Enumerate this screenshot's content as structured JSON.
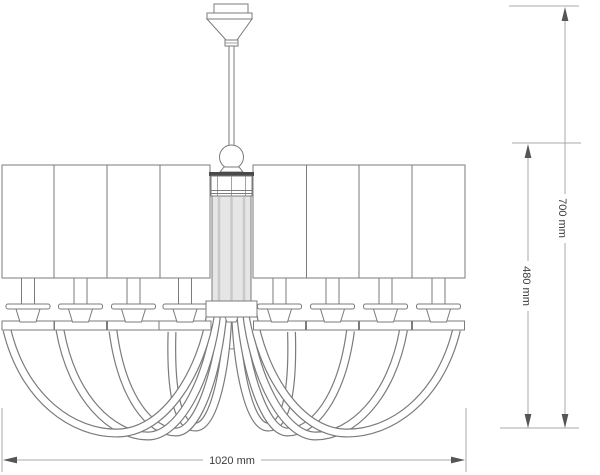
{
  "drawing": {
    "subject": "chandelier-front-elevation",
    "shade_panels_left": 4,
    "shade_panels_right": 4,
    "arm_count": 8,
    "dimensions": {
      "width_label": "1020 mm",
      "overall_height_label": "700 mm",
      "body_height_label": "480 mm"
    },
    "colors": {
      "line": "#7b7b7b",
      "dimension_line": "#a8a8a8",
      "arrow": "#555555",
      "text": "#3c3c3c",
      "column_fill": "#e6e6e6",
      "dark_band": "#4a4a4a"
    }
  }
}
